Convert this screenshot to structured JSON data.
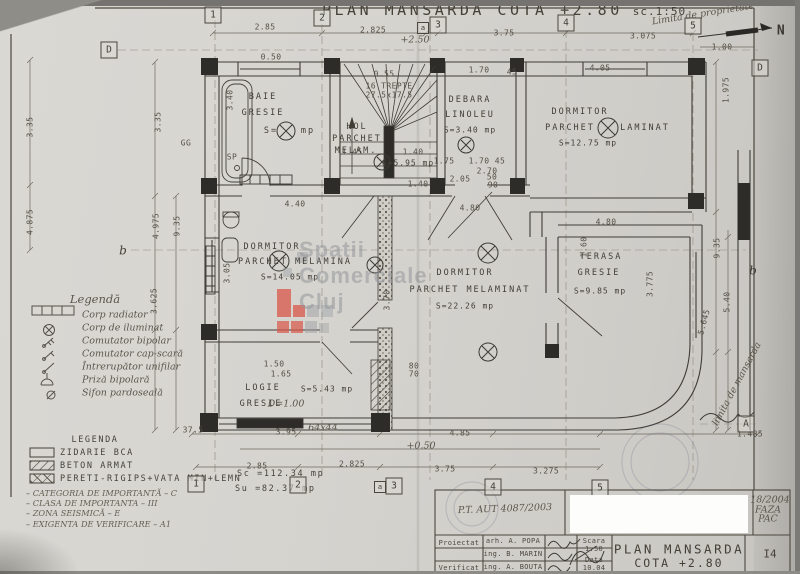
{
  "title": {
    "main": "PLAN MANSARDA COTA +2.80",
    "scale": "sc.1:50"
  },
  "watermark": {
    "text": "Spatii Comerciale Cluj",
    "red": "#d9574a",
    "gray": "#9b9fa3"
  },
  "legend_hand": {
    "title": "Legendă",
    "items": [
      "Corp radiator",
      "Corp de iluminat",
      "Comutator bipolar",
      "Comutator cap-scară",
      "Întrerupător unifilar",
      "Priză bipolară",
      "Sifon pardoseală"
    ]
  },
  "legend_print": {
    "title": "LEGENDA",
    "items": [
      "ZIDARIE BCA",
      "BETON ARMAT",
      "PERETI-RIGIPS+VATA MIN+LEMN"
    ]
  },
  "notes": [
    "– CATEGORIA DE IMPORTANTĂ – C",
    "– CLASA DE IMPORTANTA – III",
    "– ZONA SEISMICĂ – E",
    "– EXIGENTA DE VERIFICARE – A1"
  ],
  "stats_labels": [
    {
      "t": "Sc =112.34 mp",
      "x": 237,
      "y": 474
    },
    {
      "t": "Su =82.37 mp",
      "x": 235,
      "y": 489
    }
  ],
  "room_labels": [
    {
      "t": "BAIE",
      "x": 263,
      "y": 97
    },
    {
      "t": "GRESIE",
      "x": 263,
      "y": 113
    },
    {
      "t": "S=",
      "x": 271,
      "y": 131
    },
    {
      "t": "mp",
      "x": 308,
      "y": 131
    },
    {
      "t": "HOL",
      "x": 357,
      "y": 127
    },
    {
      "t": "PARCHET",
      "x": 357,
      "y": 139
    },
    {
      "t": "MELAM.",
      "x": 356,
      "y": 151
    },
    {
      "t": "S=5.95 mp",
      "x": 408,
      "y": 163,
      "c": "sm"
    },
    {
      "t": "DEBARA",
      "x": 470,
      "y": 100
    },
    {
      "t": "LINOLEU",
      "x": 470,
      "y": 115
    },
    {
      "t": "S=3.40 mp",
      "x": 470,
      "y": 130,
      "c": "sm"
    },
    {
      "t": "DORMITOR",
      "x": 580,
      "y": 112
    },
    {
      "t": "PARCHET",
      "x": 570,
      "y": 128
    },
    {
      "t": "LAMINAT",
      "x": 645,
      "y": 128
    },
    {
      "t": "S=12.75 mp",
      "x": 588,
      "y": 143,
      "c": "sm"
    },
    {
      "t": "DORMITOR",
      "x": 272,
      "y": 247
    },
    {
      "t": "PARCHET MELAMINA",
      "x": 295,
      "y": 262
    },
    {
      "t": "S=14.05 mp",
      "x": 290,
      "y": 277,
      "c": "sm"
    },
    {
      "t": "DORMITOR",
      "x": 465,
      "y": 273
    },
    {
      "t": "PARCHET MELAMINAT",
      "x": 470,
      "y": 290
    },
    {
      "t": "S=22.26 mp",
      "x": 465,
      "y": 306,
      "c": "sm"
    },
    {
      "t": "TERASA",
      "x": 601,
      "y": 257
    },
    {
      "t": "GRESIE",
      "x": 599,
      "y": 273
    },
    {
      "t": "S=9.85 mp",
      "x": 600,
      "y": 291,
      "c": "sm"
    },
    {
      "t": "LOGIE",
      "x": 263,
      "y": 388
    },
    {
      "t": "GRESIE",
      "x": 261,
      "y": 404
    },
    {
      "t": "S=5.43 mp",
      "x": 327,
      "y": 389,
      "c": "sm"
    }
  ],
  "dim_labels": [
    {
      "t": "2.85",
      "x": 265,
      "y": 27
    },
    {
      "t": "2.825",
      "x": 373,
      "y": 30
    },
    {
      "t": "3.75",
      "x": 504,
      "y": 33
    },
    {
      "t": "3.075",
      "x": 643,
      "y": 36
    },
    {
      "t": "1.00",
      "x": 722,
      "y": 47
    },
    {
      "t": "1.975",
      "x": 726,
      "y": 90,
      "r": -90
    },
    {
      "t": "0.50",
      "x": 271,
      "y": 57
    },
    {
      "t": "0.55",
      "x": 384,
      "y": 74
    },
    {
      "t": "1.70",
      "x": 479,
      "y": 70
    },
    {
      "t": "45",
      "x": 512,
      "y": 72
    },
    {
      "t": "4.05",
      "x": 600,
      "y": 68
    },
    {
      "t": "3.40",
      "x": 230,
      "y": 100,
      "r": -90
    },
    {
      "t": "16 TREPTE",
      "x": 389,
      "y": 86
    },
    {
      "t": "27.5x17.5",
      "x": 389,
      "y": 95
    },
    {
      "t": "1.45",
      "x": 352,
      "y": 152
    },
    {
      "t": "1.40",
      "x": 413,
      "y": 152
    },
    {
      "t": "1.75",
      "x": 444,
      "y": 161
    },
    {
      "t": "1.70",
      "x": 479,
      "y": 161
    },
    {
      "t": "45",
      "x": 500,
      "y": 161
    },
    {
      "t": "2.70",
      "x": 487,
      "y": 171
    },
    {
      "t": "2.05",
      "x": 460,
      "y": 179
    },
    {
      "t": "50",
      "x": 492,
      "y": 177
    },
    {
      "t": "90",
      "x": 493,
      "y": 185
    },
    {
      "t": "1.40",
      "x": 418,
      "y": 184
    },
    {
      "t": "4.40",
      "x": 295,
      "y": 204
    },
    {
      "t": "4.80",
      "x": 470,
      "y": 208
    },
    {
      "t": "4.80",
      "x": 606,
      "y": 222
    },
    {
      "t": "3.05",
      "x": 227,
      "y": 273,
      "r": -90
    },
    {
      "t": "3.70",
      "x": 387,
      "y": 300,
      "r": -90
    },
    {
      "t": "1.60",
      "x": 584,
      "y": 247,
      "r": -90
    },
    {
      "t": "9.35",
      "x": 717,
      "y": 248,
      "r": -90
    },
    {
      "t": "5.40",
      "x": 727,
      "y": 302,
      "r": -90
    },
    {
      "t": "5.645",
      "x": 704,
      "y": 322,
      "r": -75
    },
    {
      "t": "3.775",
      "x": 650,
      "y": 284,
      "r": -90
    },
    {
      "t": "4.975",
      "x": 156,
      "y": 226,
      "r": -90
    },
    {
      "t": "9.35",
      "x": 177,
      "y": 226,
      "r": -90
    },
    {
      "t": "3.625",
      "x": 154,
      "y": 301,
      "r": -90
    },
    {
      "t": "3.35",
      "x": 158,
      "y": 122,
      "r": -90
    },
    {
      "t": "3.35",
      "x": 30,
      "y": 127,
      "r": -90
    },
    {
      "t": "4.875",
      "x": 30,
      "y": 222,
      "r": -90
    },
    {
      "t": "1.50",
      "x": 274,
      "y": 364
    },
    {
      "t": "1.65",
      "x": 281,
      "y": 374
    },
    {
      "t": "80",
      "x": 414,
      "y": 366
    },
    {
      "t": "70",
      "x": 414,
      "y": 374
    },
    {
      "t": "3.95",
      "x": 286,
      "y": 432
    },
    {
      "t": "4.85",
      "x": 460,
      "y": 433
    },
    {
      "t": "1.485",
      "x": 750,
      "y": 434
    },
    {
      "t": "2.85",
      "x": 257,
      "y": 466
    },
    {
      "t": "2.825",
      "x": 352,
      "y": 464
    },
    {
      "t": "3.75",
      "x": 445,
      "y": 469
    },
    {
      "t": "3.275",
      "x": 546,
      "y": 471
    },
    {
      "t": "37.5",
      "x": 193,
      "y": 430
    },
    {
      "t": "SP",
      "x": 232,
      "y": 157
    },
    {
      "t": "GG",
      "x": 186,
      "y": 143
    },
    {
      "t": "N",
      "x": 781,
      "y": 31,
      "c": "north"
    }
  ],
  "hand_labels": [
    {
      "t": "Limita de proprietate",
      "x": 703,
      "y": 14,
      "r": -9
    },
    {
      "t": "limita de mansarda",
      "x": 737,
      "y": 384,
      "r": -62
    },
    {
      "t": "+2.50",
      "x": 415,
      "y": 40
    },
    {
      "t": "D=1.00",
      "x": 286,
      "y": 404
    },
    {
      "t": "64x44",
      "x": 323,
      "y": 428
    },
    {
      "t": "+0.50",
      "x": 421,
      "y": 446
    },
    {
      "t": "P.T. AUT 4087/2003",
      "x": 505,
      "y": 509,
      "r": -2
    },
    {
      "t": "18/2004",
      "x": 770,
      "y": 500
    },
    {
      "t": "FAZA",
      "x": 768,
      "y": 510
    },
    {
      "t": "PAC",
      "x": 768,
      "y": 519
    }
  ],
  "titleblock_labels": [
    {
      "t": "Proiectat",
      "x": 459,
      "y": 543,
      "c": "tb"
    },
    {
      "t": "Verificat",
      "x": 459,
      "y": 568,
      "c": "tb"
    },
    {
      "t": "arh. A. POPA",
      "x": 513,
      "y": 541,
      "c": "tb"
    },
    {
      "t": "ing. B. MARIN",
      "x": 513,
      "y": 554,
      "c": "tb"
    },
    {
      "t": "ing. A. BOUTA",
      "x": 513,
      "y": 567,
      "c": "tb"
    },
    {
      "t": "Scara",
      "x": 594,
      "y": 541,
      "c": "tb"
    },
    {
      "t": "1:50",
      "x": 594,
      "y": 549,
      "c": "tb"
    },
    {
      "t": "Data",
      "x": 594,
      "y": 560,
      "c": "tb"
    },
    {
      "t": "10.04",
      "x": 594,
      "y": 568,
      "c": "tb"
    },
    {
      "t": "PLAN MANSARDA",
      "x": 679,
      "y": 549,
      "c": "tbtitle"
    },
    {
      "t": "COTA +2.80",
      "x": 679,
      "y": 563,
      "c": "tbtitle2"
    },
    {
      "t": "I4",
      "x": 770,
      "y": 554,
      "c": "tbsheet"
    }
  ],
  "axes": [
    {
      "t": "1",
      "x": 213,
      "y": 15,
      "b": 1
    },
    {
      "t": "2",
      "x": 322,
      "y": 18,
      "b": 1
    },
    {
      "t": "a",
      "x": 423,
      "y": 28,
      "b": 1,
      "s": 1
    },
    {
      "t": "3",
      "x": 438,
      "y": 25,
      "b": 1
    },
    {
      "t": "4",
      "x": 566,
      "y": 23,
      "b": 1
    },
    {
      "t": "5",
      "x": 693,
      "y": 26,
      "b": 1
    },
    {
      "t": "1",
      "x": 196,
      "y": 484,
      "b": 1
    },
    {
      "t": "2",
      "x": 298,
      "y": 485,
      "b": 1
    },
    {
      "t": "a",
      "x": 380,
      "y": 487,
      "b": 1,
      "s": 1
    },
    {
      "t": "3",
      "x": 394,
      "y": 486,
      "b": 1
    },
    {
      "t": "4",
      "x": 493,
      "y": 487,
      "b": 1
    },
    {
      "t": "5",
      "x": 600,
      "y": 488,
      "b": 1
    },
    {
      "t": "D",
      "x": 109,
      "y": 50,
      "b": 1
    },
    {
      "t": "D",
      "x": 760,
      "y": 68,
      "b": 1
    },
    {
      "t": "A",
      "x": 746,
      "y": 424,
      "b": 1
    },
    {
      "t": "b",
      "x": 123,
      "y": 250
    },
    {
      "t": "b",
      "x": 753,
      "y": 270
    }
  ]
}
